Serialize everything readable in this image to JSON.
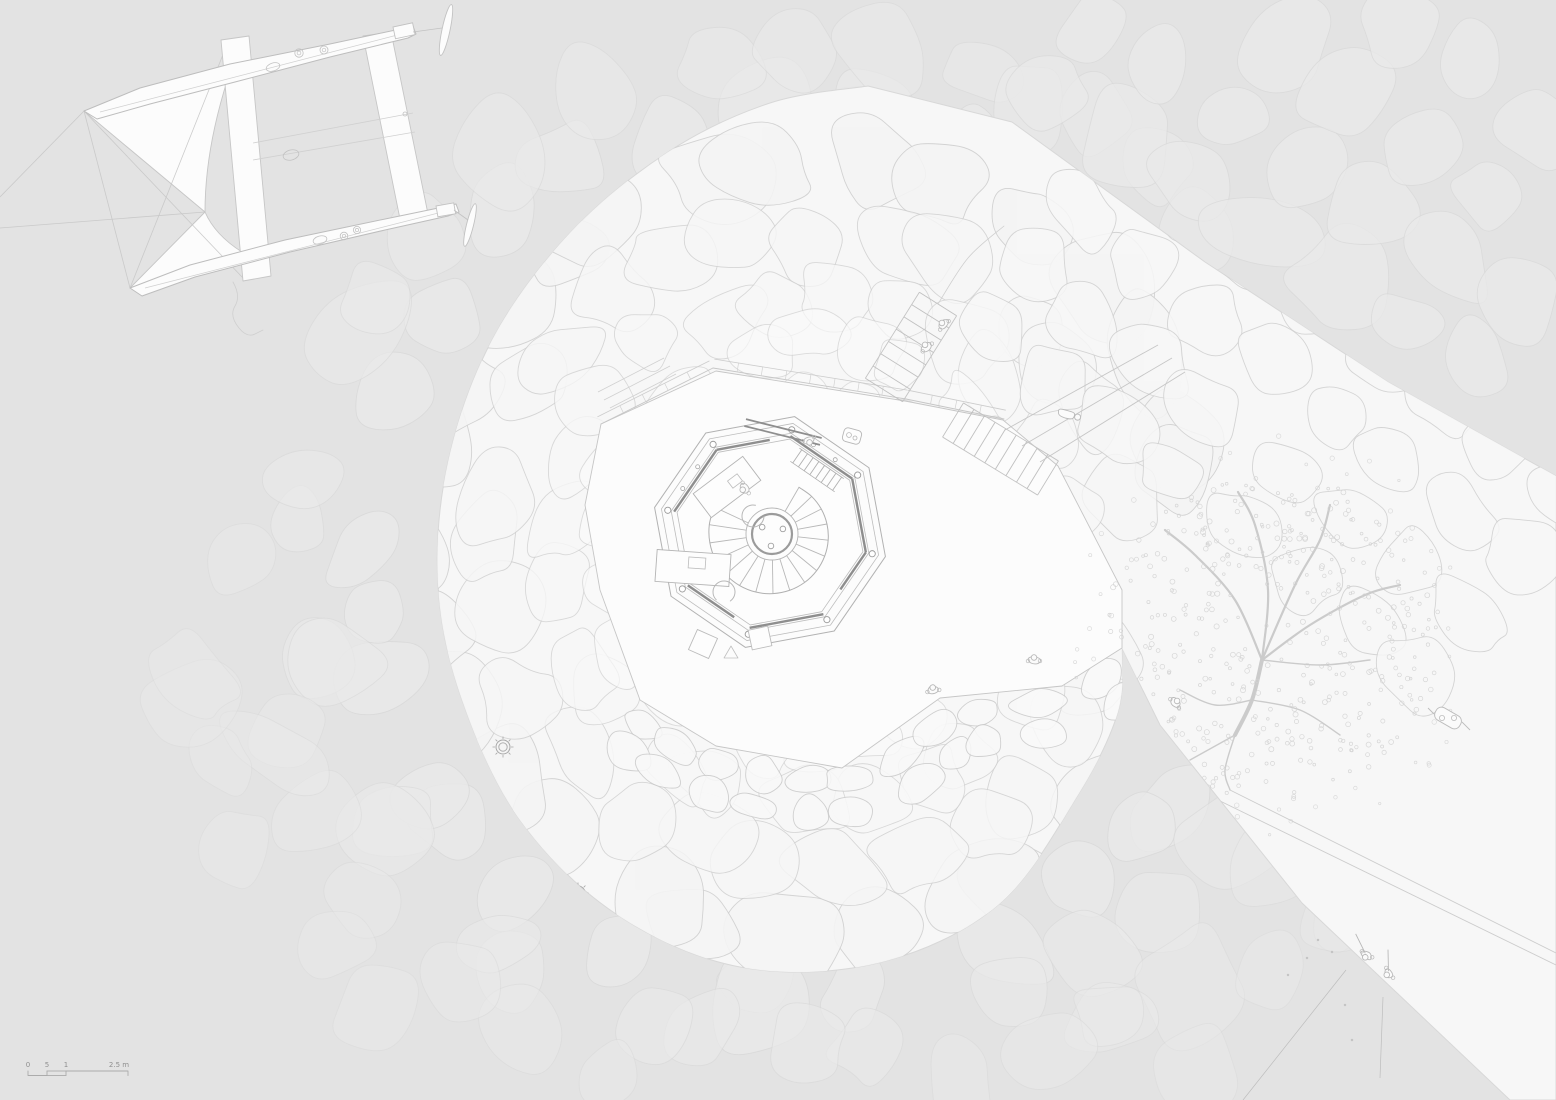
{
  "colors": {
    "water": "#e3e3e3",
    "land": "#f7f7f7",
    "stone_fill": "#fbfbfb",
    "stone_stroke": "#cfcfcf",
    "submerged_stroke": "#d9d9d9",
    "submerged_fill": "#eaeaea",
    "plaza_fill": "#fcfcfc",
    "plaza_stroke": "#c6c6c6",
    "line": "#b8b8b8",
    "dark_wall": "#8e8e8e",
    "figure": "#b9b9b9",
    "tree": "#cbcbcb",
    "leaf": "#d3d3d3",
    "boat_stroke": "#c6c6c6",
    "boat_fill": "#fcfcfc",
    "scale_text": "#8f8f8f",
    "scale_line": "#ababab"
  },
  "scale_bar": {
    "labels": [
      "0",
      "5",
      "1",
      "2.5 m"
    ],
    "label_x": [
      28,
      47,
      66,
      119
    ],
    "label_y": 1067,
    "ticks": [
      28,
      47,
      66,
      128
    ],
    "bar_y": 1071
  },
  "land_outline": {
    "straight": [
      [
        868,
        86
      ],
      [
        1012,
        122
      ],
      [
        1205,
        262
      ],
      [
        1388,
        382
      ],
      [
        1556,
        476
      ],
      [
        1556,
        1100
      ],
      [
        1510,
        1100
      ],
      [
        1302,
        903
      ],
      [
        1160,
        725
      ],
      [
        1122,
        648
      ]
    ],
    "blob": [
      [
        1122,
        648
      ],
      [
        1118,
        712
      ],
      [
        1078,
        795
      ],
      [
        998,
        905
      ],
      [
        878,
        963
      ],
      [
        740,
        967
      ],
      [
        616,
        914
      ],
      [
        520,
        820
      ],
      [
        462,
        700
      ],
      [
        438,
        585
      ],
      [
        448,
        462
      ],
      [
        492,
        340
      ],
      [
        570,
        233
      ],
      [
        668,
        152
      ],
      [
        770,
        103
      ],
      [
        868,
        86
      ]
    ]
  },
  "stone_mound": {
    "seed": 7,
    "cx": 812,
    "cy": 548,
    "rings": [
      {
        "r": 385,
        "size": 96
      },
      {
        "r": 318,
        "size": 86
      },
      {
        "r": 258,
        "size": 76
      },
      {
        "r": 202,
        "size": 66
      },
      {
        "r": 150,
        "size": 58
      },
      {
        "r": 104,
        "size": 50
      },
      {
        "r": 62,
        "size": 42
      }
    ]
  },
  "stone_band": {
    "seed": 11,
    "ax": 1075,
    "ay": 195,
    "bx": 1520,
    "by": 548,
    "row_offsets": [
      -70,
      8,
      84,
      158
    ],
    "col_step": 80,
    "cols": 8,
    "size": 80
  },
  "retaining_wall": {
    "seed": 23,
    "line": [
      [
        638,
        700
      ],
      [
        700,
        740
      ],
      [
        788,
        764
      ],
      [
        870,
        760
      ],
      [
        940,
        700
      ],
      [
        1010,
        687
      ],
      [
        1068,
        682
      ],
      [
        1112,
        645
      ]
    ],
    "offsets": [
      18,
      50
    ],
    "w": 50,
    "h": 32
  },
  "submerged": {
    "seed": 41,
    "rings": [
      445,
      505,
      565,
      635
    ],
    "size": 86,
    "corner_rows": 4,
    "corner_cols": 8
  },
  "plaza": {
    "points": [
      [
        601,
        424
      ],
      [
        716,
        371
      ],
      [
        905,
        401
      ],
      [
        1003,
        420
      ],
      [
        1058,
        466
      ],
      [
        1122,
        590
      ],
      [
        1122,
        648
      ],
      [
        1062,
        686
      ],
      [
        940,
        698
      ],
      [
        842,
        768
      ],
      [
        716,
        746
      ],
      [
        640,
        700
      ],
      [
        600,
        590
      ],
      [
        585,
        505
      ]
    ],
    "coping_top": [
      [
        713,
        368
      ],
      [
        906,
        399
      ],
      [
        1004,
        419
      ]
    ],
    "coping_nw": [
      [
        601,
        424
      ],
      [
        713,
        368
      ]
    ],
    "triangle_marker": [
      731,
      652
    ]
  },
  "octagon": {
    "cx": 770,
    "cy": 532,
    "rot": 12,
    "radii": [
      118,
      111,
      101,
      95
    ],
    "dark_sides": [
      [
        6,
        0,
        1
      ],
      [
        7,
        0,
        0.72
      ],
      [
        0,
        0,
        1
      ],
      [
        1,
        0,
        1
      ],
      [
        2,
        0,
        0.6
      ],
      [
        3,
        0,
        1
      ],
      [
        4,
        0.25,
        1
      ]
    ],
    "column_r": 3.1
  },
  "spiral_stair": {
    "cx": 772,
    "cy": 534,
    "hub_r1": 26,
    "hub_r2": 20,
    "r_start": 54,
    "r_end": 64,
    "a_start": -60,
    "a_end": 205,
    "steps": 16,
    "bolts": [
      95,
      215,
      335
    ],
    "bolt_ring": 12,
    "bolt_r": 2.8
  },
  "furniture": {
    "desks": [
      {
        "x": 727,
        "y": 487,
        "w": 62,
        "h": 30,
        "rot": -37,
        "item": [
          735,
          481,
          12,
          9
        ]
      },
      {
        "x": 693,
        "y": 568,
        "w": 74,
        "h": 32,
        "rot": 4,
        "item": [
          697,
          563,
          17,
          11
        ]
      }
    ],
    "chairs": [
      [
        753,
        516,
        -37
      ],
      [
        724,
        592,
        95
      ]
    ],
    "stools": [
      [
        703,
        644,
        24,
        22
      ],
      [
        760,
        638,
        -12,
        20
      ]
    ],
    "bench": {
      "cx": 783,
      "cy": 432,
      "len": 78,
      "wid": 7,
      "rot": 14
    },
    "entry_fixture": [
      852,
      436
    ]
  },
  "stairs": {
    "stair_a": {
      "x1": 953,
      "y1": 420,
      "x2": 1048,
      "y2": 478,
      "half": 20,
      "treads": 9
    },
    "path_b": {
      "x1": 884,
      "y1": 390,
      "x2": 938,
      "y2": 304,
      "half": 22,
      "treads": 7
    },
    "path_b_curve": [
      [
        938,
        304
      ],
      [
        968,
        258
      ],
      [
        1004,
        226
      ]
    ],
    "ramp": [
      [
        [
          1005,
          430
        ],
        [
          1158,
          345
        ]
      ],
      [
        [
          1022,
          446
        ],
        [
          1172,
          358
        ]
      ],
      [
        [
          1040,
          462
        ],
        [
          1185,
          372
        ]
      ]
    ]
  },
  "tree": {
    "seed": 31,
    "cx": 1272,
    "cy": 638,
    "canopy_r": 168,
    "leaves": 430,
    "spill": 50,
    "branches": [
      [
        [
          1235,
          735
        ],
        [
          1252,
          700
        ],
        [
          1262,
          660
        ]
      ],
      [
        [
          1262,
          660
        ],
        [
          1235,
          600
        ],
        [
          1195,
          555
        ],
        [
          1165,
          530
        ]
      ],
      [
        [
          1262,
          660
        ],
        [
          1268,
          590
        ],
        [
          1255,
          525
        ],
        [
          1238,
          492
        ]
      ],
      [
        [
          1262,
          660
        ],
        [
          1295,
          585
        ],
        [
          1320,
          540
        ],
        [
          1330,
          505
        ]
      ],
      [
        [
          1262,
          660
        ],
        [
          1310,
          625
        ],
        [
          1365,
          595
        ],
        [
          1400,
          585
        ]
      ],
      [
        [
          1262,
          660
        ],
        [
          1320,
          665
        ],
        [
          1370,
          660
        ]
      ],
      [
        [
          1252,
          700
        ],
        [
          1300,
          710
        ],
        [
          1340,
          735
        ]
      ],
      [
        [
          1252,
          700
        ],
        [
          1215,
          705
        ],
        [
          1180,
          690
        ]
      ],
      [
        [
          1235,
          735
        ],
        [
          1225,
          770
        ],
        [
          1230,
          790
        ]
      ],
      [
        [
          1235,
          735
        ],
        [
          1190,
          760
        ]
      ]
    ]
  },
  "cart": {
    "x": 1448,
    "y": 718,
    "rot": 30
  },
  "pier_lines": [
    [
      [
        1230,
        790
      ],
      [
        1556,
        953
      ]
    ],
    [
      [
        1218,
        800
      ],
      [
        1556,
        965
      ]
    ]
  ],
  "fishing": {
    "lines": [
      [
        [
          1346,
          970
        ],
        [
          1243,
          1100
        ]
      ],
      [
        [
          1383,
          997
        ],
        [
          1380,
          1078
        ]
      ]
    ],
    "specks": [
      [
        1318,
        940
      ],
      [
        1332,
        952
      ],
      [
        1307,
        958
      ],
      [
        1345,
        1005
      ],
      [
        1352,
        1040
      ],
      [
        1288,
        975
      ]
    ]
  },
  "figures": [
    {
      "name": "walker-1",
      "x": 926,
      "y": 346,
      "rot": -40,
      "pose": "walk"
    },
    {
      "name": "walker-2",
      "x": 943,
      "y": 324,
      "rot": -45,
      "pose": "walk"
    },
    {
      "name": "lounger",
      "x": 1066,
      "y": 414,
      "rot": 15,
      "pose": "lounge"
    },
    {
      "name": "wall-leaner",
      "x": 933,
      "y": 689,
      "rot": -10,
      "pose": "walk"
    },
    {
      "name": "plaza-sitter",
      "x": 1034,
      "y": 659,
      "rot": 0,
      "pose": "sit"
    },
    {
      "name": "person-at-desk",
      "x": 744,
      "y": 489,
      "rot": -120,
      "pose": "walk"
    },
    {
      "name": "person-at-entrance",
      "x": 809,
      "y": 441,
      "rot": 160,
      "pose": "walk"
    },
    {
      "name": "pier-walker",
      "x": 1176,
      "y": 702,
      "rot": 45,
      "pose": "sit"
    },
    {
      "name": "fisher-1",
      "x": 1366,
      "y": 956,
      "rot": 210,
      "pose": "fish"
    },
    {
      "name": "fisher-2",
      "x": 1388,
      "y": 974,
      "rot": 235,
      "pose": "fish"
    }
  ],
  "bollards": [
    [
      503,
      747
    ],
    [
      578,
      893
    ]
  ],
  "boat": {
    "hullA": "M84,111 L140,88 230,64 330,44 405,28 413,26 416,34 408,38 330,57 235,82 150,104 97,119 Z",
    "hullA_deck": [
      [
        100,
        112
      ],
      [
        405,
        33
      ]
    ],
    "hullB": "M130,288 L190,265 285,240 390,218 448,206 456,204 459,212 448,216 385,230 290,252 195,277 142,296 Z",
    "hullB_deck": [
      [
        145,
        288
      ],
      [
        450,
        210
      ]
    ],
    "beams": [
      [
        [
          221,
          40
        ],
        [
          249,
          36
        ],
        [
          271,
          276
        ],
        [
          243,
          281
        ]
      ],
      [
        [
          363,
          36
        ],
        [
          391,
          32
        ],
        [
          428,
          214
        ],
        [
          400,
          219
        ]
      ]
    ],
    "seams": [
      [
        [
          253,
          143
        ],
        [
          413,
          113
        ]
      ],
      [
        [
          253,
          160
        ],
        [
          415,
          132
        ]
      ]
    ],
    "sails": [
      "M84,111 L228,78 Q205,150 205,212 Z",
      "M130,288 L242,252 Q215,235 205,212 Z"
    ],
    "rigging": [
      [
        [
          84,
          111
        ],
        [
          0,
          197
        ]
      ],
      [
        [
          205,
          212
        ],
        [
          0,
          228
        ]
      ],
      [
        [
          84,
          111
        ],
        [
          130,
          288
        ]
      ],
      [
        [
          84,
          111
        ],
        [
          243,
          278
        ]
      ],
      [
        [
          130,
          288
        ],
        [
          226,
          47
        ]
      ]
    ],
    "rudders": [
      {
        "box": [
          393,
          27,
          20,
          12,
          -12
        ],
        "blade": [
          446,
          30,
          4,
          26,
          12
        ],
        "tiller": [
          [
            413,
            32
          ],
          [
            442,
            28
          ]
        ]
      },
      {
        "box": [
          436,
          206,
          18,
          11,
          -10
        ],
        "blade": [
          470,
          225,
          3.5,
          22,
          14
        ],
        "tiller": [
          [
            454,
            210
          ],
          [
            468,
            220
          ]
        ]
      }
    ],
    "fittings": {
      "ellipses": [
        [
          273,
          67,
          7,
          4,
          -18
        ],
        [
          291,
          155,
          8,
          5,
          -15
        ],
        [
          320,
          240,
          7,
          4,
          -15
        ]
      ],
      "rings": [
        [
          299,
          53,
          4.2
        ],
        [
          324,
          50,
          4
        ],
        [
          344,
          236,
          3.8
        ],
        [
          357,
          230,
          3.6
        ]
      ],
      "dots": [
        [
          405,
          114,
          2
        ]
      ]
    },
    "wake": "M233,282 q8,14 2,24 q-6,10 4,22 q8,10 16,6 q6,-3 8,-4"
  }
}
